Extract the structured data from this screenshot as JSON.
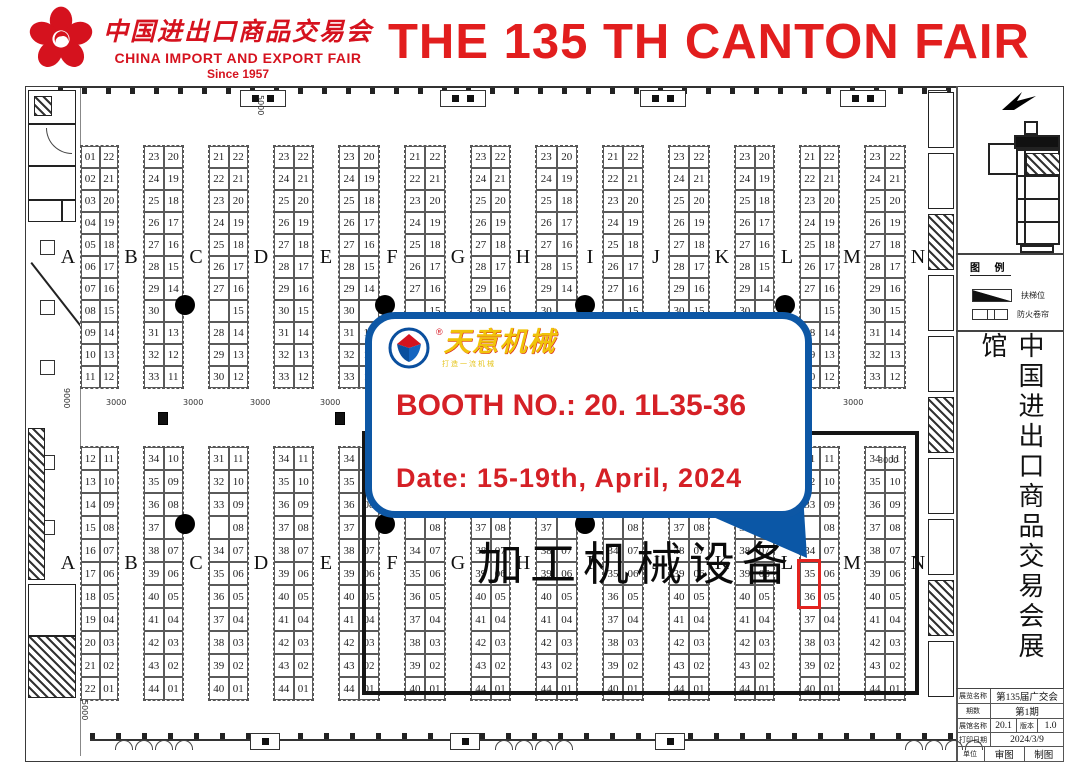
{
  "header": {
    "logo_cn": "中国进出口商品交易会",
    "logo_en": "CHINA IMPORT AND EXPORT FAIR",
    "logo_since": "Since 1957",
    "title": "THE 135 TH CANTON FAIR",
    "brand_red": "#d5121e"
  },
  "callout": {
    "brand": "天意机械",
    "reg": "®",
    "slogan": "打造一流机械",
    "booth_line": "BOOTH NO.: 20. 1L35-36",
    "date_line": "Date: 15-19th, April, 2024",
    "border_color": "#0d57a5",
    "text_color": "#d52026",
    "brand_color": "#f0c30a"
  },
  "map": {
    "letters": [
      "A",
      "B",
      "C",
      "D",
      "E",
      "F",
      "G",
      "H",
      "I",
      "J",
      "K",
      "L",
      "M",
      "N"
    ],
    "letter_x": [
      68,
      131,
      196,
      261,
      326,
      392,
      458,
      523,
      590,
      656,
      722,
      787,
      852,
      918
    ],
    "patterns": {
      "P1": [
        [
          "01",
          "22"
        ],
        [
          "02",
          "21"
        ],
        [
          "03",
          "20"
        ],
        [
          "04",
          "19"
        ],
        [
          "05",
          "18"
        ],
        [
          "06",
          "17"
        ],
        [
          "07",
          "16"
        ],
        [
          "08",
          "15"
        ],
        [
          "09",
          "14"
        ],
        [
          "10",
          "13"
        ],
        [
          "11",
          "12"
        ]
      ],
      "P2": [
        [
          "23",
          "20"
        ],
        [
          "24",
          "19"
        ],
        [
          "25",
          "18"
        ],
        [
          "26",
          "17"
        ],
        [
          "27",
          "16"
        ],
        [
          "28",
          "15"
        ],
        [
          "29",
          "14"
        ],
        [
          "30",
          ""
        ],
        [
          "31",
          "13"
        ],
        [
          "32",
          "12"
        ],
        [
          "33",
          "11"
        ]
      ],
      "P3": [
        [
          "21",
          "22"
        ],
        [
          "22",
          "21"
        ],
        [
          "23",
          "20"
        ],
        [
          "24",
          "19"
        ],
        [
          "25",
          "18"
        ],
        [
          "26",
          "17"
        ],
        [
          "27",
          "16"
        ],
        [
          "",
          "15"
        ],
        [
          "28",
          "14"
        ],
        [
          "29",
          "13"
        ],
        [
          "30",
          "12"
        ]
      ],
      "P4": [
        [
          "23",
          "22"
        ],
        [
          "24",
          "21"
        ],
        [
          "25",
          "20"
        ],
        [
          "26",
          "19"
        ],
        [
          "27",
          "18"
        ],
        [
          "28",
          "17"
        ],
        [
          "29",
          "16"
        ],
        [
          "30",
          "15"
        ],
        [
          "31",
          "14"
        ],
        [
          "32",
          "13"
        ],
        [
          "33",
          "12"
        ]
      ],
      "Q1": [
        [
          "12",
          "11"
        ],
        [
          "13",
          "10"
        ],
        [
          "14",
          "09"
        ],
        [
          "15",
          "08"
        ],
        [
          "16",
          "07"
        ],
        [
          "17",
          "06"
        ],
        [
          "18",
          "05"
        ],
        [
          "19",
          "04"
        ],
        [
          "20",
          "03"
        ],
        [
          "21",
          "02"
        ],
        [
          "22",
          "01"
        ]
      ],
      "Q2": [
        [
          "34",
          "10"
        ],
        [
          "35",
          "09"
        ],
        [
          "36",
          "08"
        ],
        [
          "37",
          ""
        ],
        [
          "38",
          "07"
        ],
        [
          "39",
          "06"
        ],
        [
          "40",
          "05"
        ],
        [
          "41",
          "04"
        ],
        [
          "42",
          "03"
        ],
        [
          "43",
          "02"
        ],
        [
          "44",
          "01"
        ]
      ],
      "Q3": [
        [
          "31",
          "11"
        ],
        [
          "32",
          "10"
        ],
        [
          "33",
          "09"
        ],
        [
          "",
          "08"
        ],
        [
          "34",
          "07"
        ],
        [
          "35",
          "06"
        ],
        [
          "36",
          "05"
        ],
        [
          "37",
          "04"
        ],
        [
          "38",
          "03"
        ],
        [
          "39",
          "02"
        ],
        [
          "40",
          "01"
        ]
      ],
      "Q4": [
        [
          "34",
          "11"
        ],
        [
          "35",
          "10"
        ],
        [
          "36",
          "09"
        ],
        [
          "37",
          "08"
        ],
        [
          "38",
          "07"
        ],
        [
          "39",
          "06"
        ],
        [
          "40",
          "05"
        ],
        [
          "41",
          "04"
        ],
        [
          "42",
          "03"
        ],
        [
          "43",
          "02"
        ],
        [
          "44",
          "01"
        ]
      ]
    },
    "sections": [
      {
        "y": 145,
        "row_h": 22,
        "letter_y": 246,
        "blocks": [
          "P1",
          "P2",
          "P3",
          "P4",
          "P2",
          "P3",
          "P4",
          "P2",
          "P3",
          "P4",
          "P2",
          "P3",
          "P4"
        ]
      },
      {
        "y": 446,
        "row_h": 23,
        "letter_y": 552,
        "blocks": [
          "Q1",
          "Q2",
          "Q3",
          "Q4",
          "Q2",
          "Q3",
          "Q4",
          "Q2",
          "Q3",
          "Q4",
          "Q2",
          "Q3",
          "Q4"
        ]
      }
    ],
    "dots": [
      [
        185,
        305
      ],
      [
        385,
        305
      ],
      [
        585,
        305
      ],
      [
        785,
        305
      ],
      [
        185,
        524
      ],
      [
        385,
        524
      ],
      [
        585,
        524
      ],
      [
        785,
        524
      ]
    ],
    "dims": [
      {
        "t": "5000",
        "x": 256,
        "y": 95,
        "v": true
      },
      {
        "t": "9000",
        "x": 62,
        "y": 388,
        "v": true
      },
      {
        "t": "3000",
        "x": 106,
        "y": 398
      },
      {
        "t": "3000",
        "x": 183,
        "y": 398
      },
      {
        "t": "3000",
        "x": 250,
        "y": 398
      },
      {
        "t": "3000",
        "x": 320,
        "y": 398
      },
      {
        "t": "3000",
        "x": 843,
        "y": 398
      },
      {
        "t": "3000",
        "x": 878,
        "y": 456
      },
      {
        "t": "5000",
        "x": 80,
        "y": 700,
        "v": true
      }
    ],
    "exits": [
      [
        158,
        412
      ],
      [
        335,
        412
      ]
    ],
    "big_label": "加工机械设备",
    "highlight": {
      "block": 11,
      "row": 5,
      "rows": 2,
      "color": "#e3231f",
      "booths": [
        "35",
        "36"
      ]
    }
  },
  "sidebar": {
    "legend_title": "图 例",
    "legend_items": [
      "扶梯位",
      "防火卷帘"
    ],
    "vertical_title": "中国进出口商品交易会展馆"
  },
  "info_table": {
    "rows": [
      [
        "展览名称",
        "第135届广交会"
      ],
      [
        "期数",
        "第1期"
      ],
      [
        "展馆名称",
        "20.1",
        "版本",
        "1.0"
      ],
      [
        "打印日期",
        "2024/3/9"
      ],
      [
        "单位",
        "审图",
        "制图"
      ]
    ]
  }
}
